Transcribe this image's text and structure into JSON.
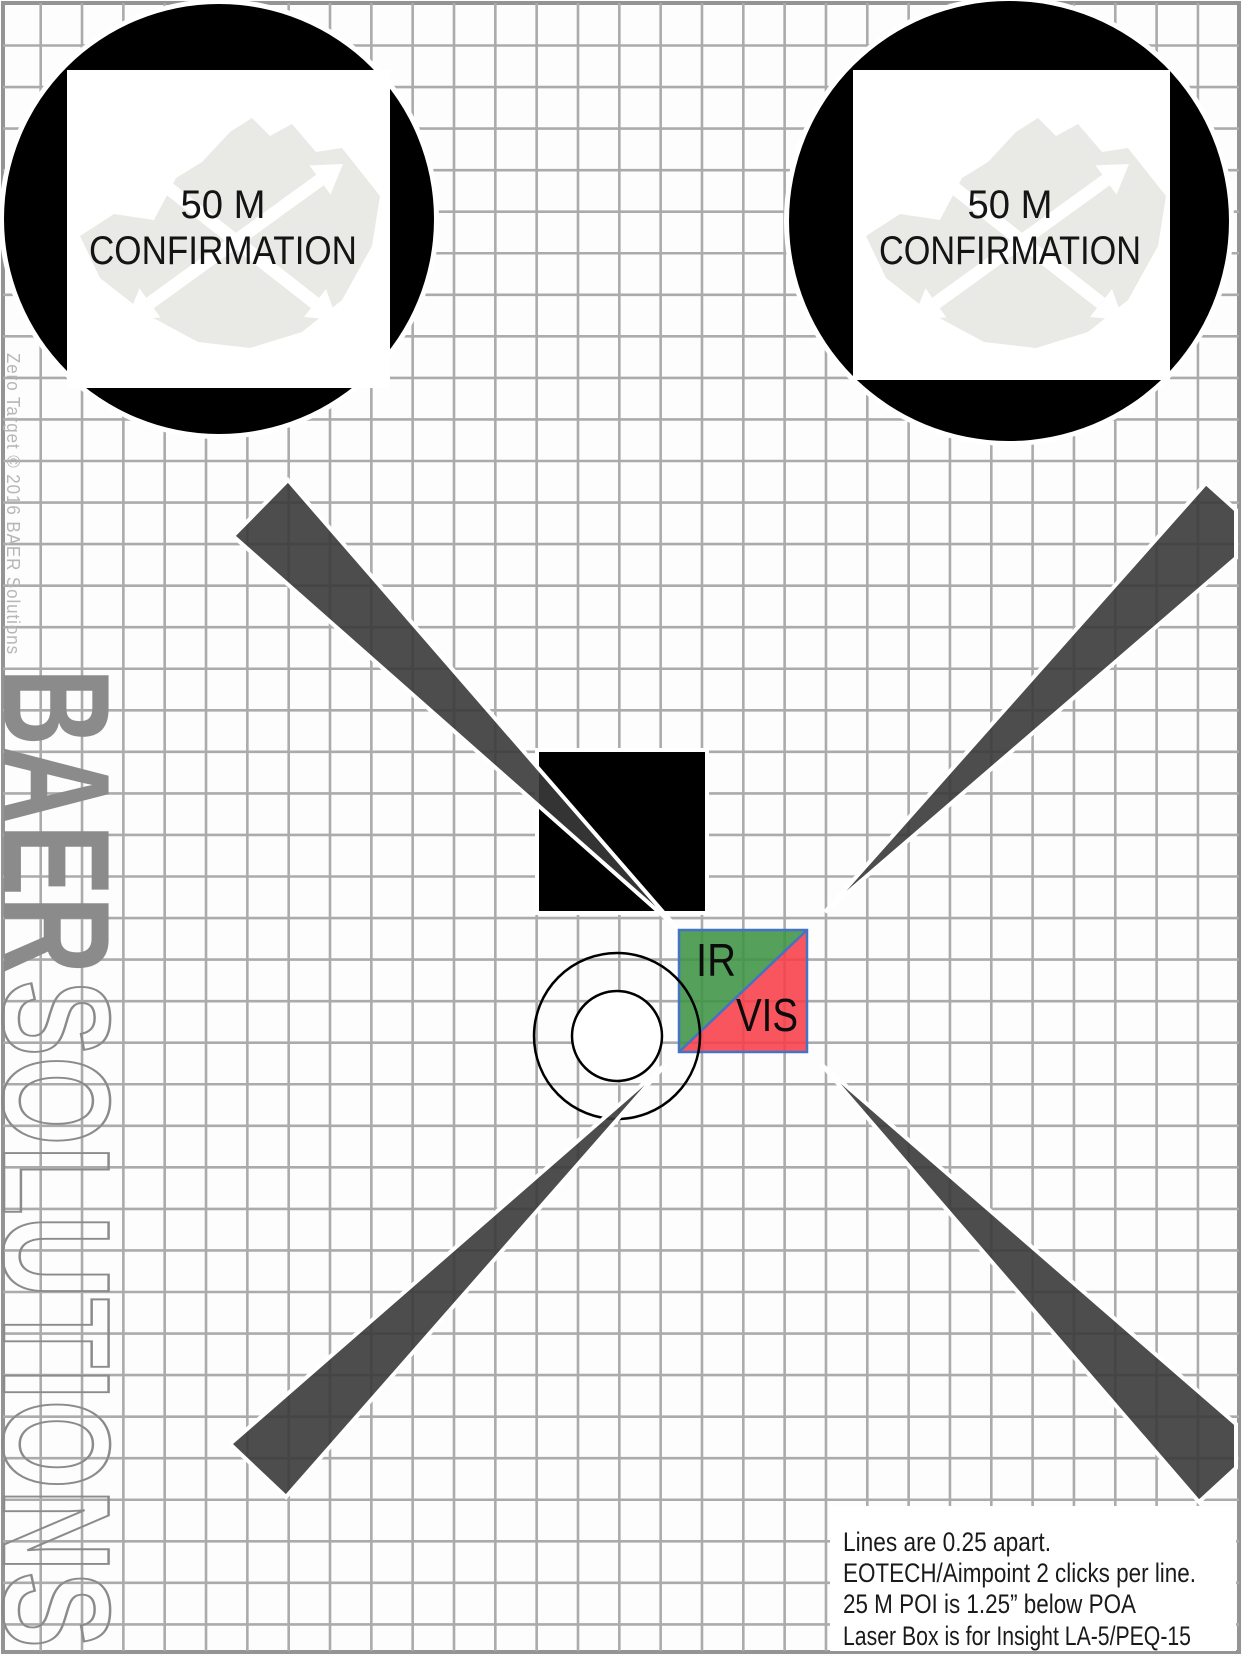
{
  "branding": {
    "company_solid": "BAER",
    "company_outline": "SOLUTIONS",
    "copyright": "Zero Target © 2016 BAER Solutions",
    "color": "#8b8b8b"
  },
  "confirmation_targets": {
    "left": {
      "line1": "50 M",
      "line2": "CONFIRMATION"
    },
    "right": {
      "line1": "50 M",
      "line2": "CONFIRMATION"
    }
  },
  "laser_box": {
    "ir_label": "IR",
    "vis_label": "VIS",
    "ir_color": "#3e9343",
    "vis_color": "#f83d48",
    "border_color": "#4472c4"
  },
  "instructions": {
    "lines": [
      "Lines are 0.25 apart.",
      "EOTECH/Aimpoint 2 clicks per line.",
      "25 M POI is 1.25” below POA",
      "Laser Box is for Insight LA-5/PEQ-15"
    ]
  },
  "colors": {
    "wedge": "#3a3a3a",
    "grid": "#ababab",
    "page_border": "#949494",
    "logo_gray": "#e9e9e5"
  }
}
